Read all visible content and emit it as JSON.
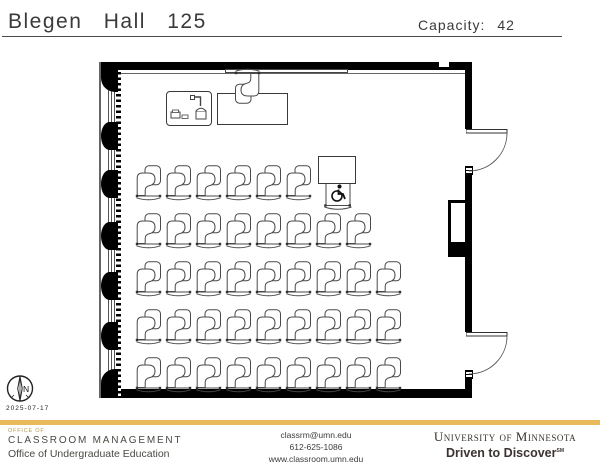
{
  "page": {
    "title": "Blegen Hall 125",
    "capacity_label": "Capacity:",
    "capacity_value": "42"
  },
  "plan": {
    "date": "2025-07-17",
    "north_label": "N",
    "seating": {
      "rows": [
        {
          "count": 6,
          "accessible_station": true
        },
        {
          "count": 8
        },
        {
          "count": 9
        },
        {
          "count": 9
        },
        {
          "count": 9
        }
      ],
      "student_chairs_total": 41,
      "accessible_stations": 1
    },
    "features": {
      "doors": 2,
      "whiteboard": true,
      "podium": true,
      "instructor_table": true,
      "instructor_chair": true,
      "windows_wall": "left"
    },
    "icons": {
      "north-compass-icon": "circle with needle and N",
      "wheelchair-icon": "accessible seating symbol",
      "document-camera-icon": "podium equipment"
    }
  },
  "footer": {
    "office_small": "OFFICE OF",
    "office_name": "CLASSROOM MANAGEMENT",
    "office_sub": "Office of Undergraduate Education",
    "contact": {
      "email": "classrm@umn.edu",
      "phone": "612-625-1086",
      "web": "www.classroom.umn.edu"
    },
    "brand": {
      "university": "University of Minnesota",
      "tagline": "Driven to Discover",
      "tm": "SM"
    }
  },
  "colors": {
    "accent_gold": "#e9ba5c",
    "wall_black": "#000000",
    "chair_line": "#4a4a4a",
    "text_dark": "#3a3a3a",
    "brand_dark": "#3b3330",
    "office_tan": "#b5964f"
  }
}
